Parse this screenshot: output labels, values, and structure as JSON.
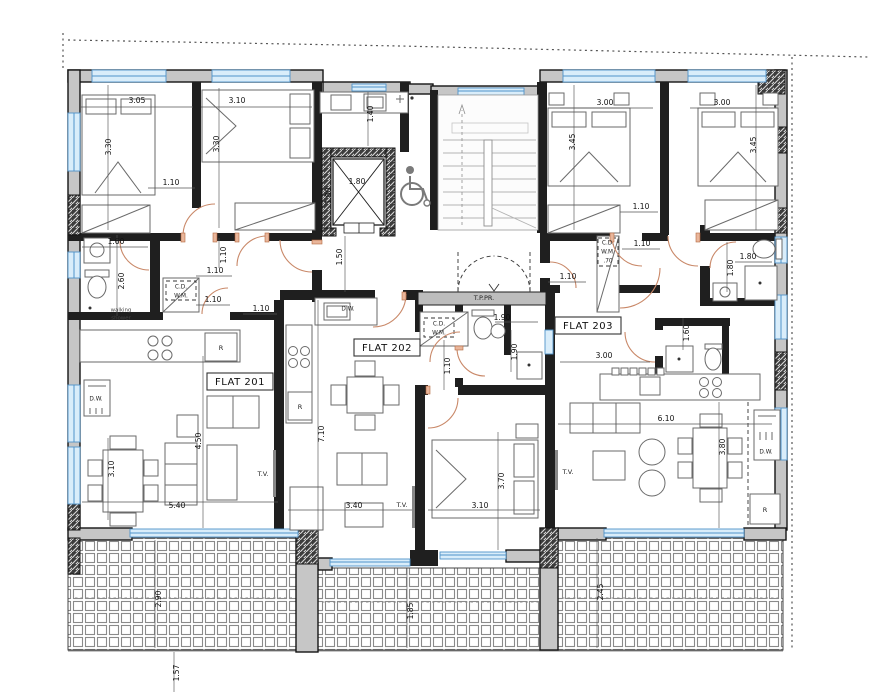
{
  "flats": {
    "flat201": "FLAT 201",
    "flat202": "FLAT 202",
    "flat203": "FLAT 203"
  },
  "labels": {
    "tppr": "T.P.PR.",
    "walking": "walking",
    "shower": "shower",
    "tv": "T.V.",
    "dw": "D.W.",
    "fridge": "R",
    "cd": "C.D.",
    "wm": "W.M.",
    "c70": ".70"
  },
  "dims": [
    "3.05",
    "3.30",
    "3.10",
    "3.30",
    "1.40",
    "1.80",
    "1.80",
    "3.00",
    "3.45",
    "3.00",
    "3.45",
    "1.10",
    "1.10",
    "1.10",
    "1.60",
    "2.60",
    "1.10",
    "1.10",
    "1.50",
    "1.10",
    "1.10",
    "1.10",
    "1.80",
    "1.80",
    "1.90",
    "1.90",
    "1.10",
    "3.00",
    "1.60",
    "4.50",
    "3.10",
    "5.40",
    "7.10",
    "3.40",
    "3.10",
    "3.70",
    "6.10",
    "3.80",
    "2.90",
    "1.85",
    "2.45",
    "1.57"
  ],
  "colors": {
    "wall_fill": "#c6c6c6",
    "wall_dark": "#1f1f1f",
    "window": "#d9edfa",
    "window_line": "#4f93c9",
    "door_arc": "#c98868",
    "tile_line": "#8a8a8a"
  }
}
